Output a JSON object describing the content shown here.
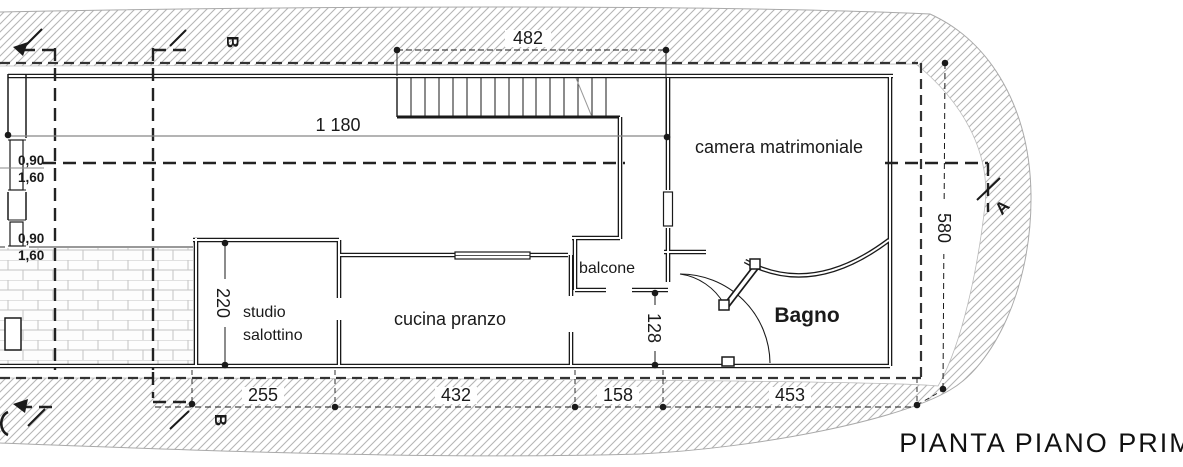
{
  "title": "PIANTA PIANO PRIMO",
  "rooms": {
    "camera": "camera matrimoniale",
    "studio_line1": "studio",
    "studio_line2": "salottino",
    "cucina": "cucina pranzo",
    "balcone": "balcone",
    "bagno": "Bagno"
  },
  "dimensions": {
    "stair_width": "482",
    "total_width": "1 180",
    "total_height": "580",
    "studio_depth": "220",
    "hallway_depth": "128",
    "bottom_chain": [
      "255",
      "432",
      "158",
      "453"
    ],
    "window1_sill": "0,90",
    "window1_height": "1,60",
    "window2_sill": "0,90",
    "window2_height": "1,60"
  },
  "section_markers": {
    "b_top": "B",
    "b_bottom": "B",
    "a_right": "A"
  },
  "colors": {
    "line": "#1a1a1a",
    "hatch": "#b5b5b5",
    "brick": "#c3c3c3",
    "gray": "#8a8a8a",
    "background": "#ffffff"
  }
}
